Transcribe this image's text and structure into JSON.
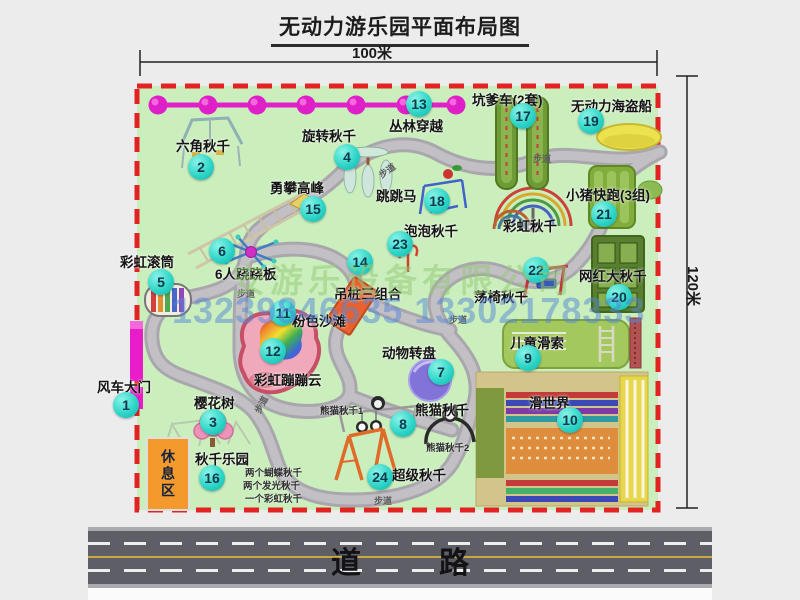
{
  "title": "无动力游乐园平面布局图",
  "dimensions": {
    "width_label": "100米",
    "height_label": "120米"
  },
  "watermark": {
    "company": "安游乐设备有限公司",
    "phone": "13239846635 13302178333"
  },
  "road": {
    "label": "道　路"
  },
  "rest_area": {
    "label": "休息区"
  },
  "rainbow_swing_label": "彩虹秋千",
  "walkways": {
    "label": "步道",
    "positions": [
      {
        "x": 378,
        "y": 164,
        "r": -35
      },
      {
        "x": 533,
        "y": 152,
        "r": 0
      },
      {
        "x": 237,
        "y": 287,
        "r": 0
      },
      {
        "x": 449,
        "y": 313,
        "r": 0
      },
      {
        "x": 252,
        "y": 398,
        "r": -62
      },
      {
        "x": 374,
        "y": 494,
        "r": 0
      }
    ]
  },
  "panda_notes": {
    "n1": "熊猫秋千1",
    "n2": "熊猫秋千2"
  },
  "swing_park": {
    "notes": [
      "两个蝴蝶秋千",
      "两个发光秋千",
      "一个彩虹秋千"
    ]
  },
  "items": [
    {
      "num": 1,
      "label": "风车大门",
      "bx": 126,
      "by": 405,
      "lx": 97,
      "ly": 376
    },
    {
      "num": 2,
      "label": "六角秋千",
      "bx": 201,
      "by": 167,
      "lx": 176,
      "ly": 135
    },
    {
      "num": 3,
      "label": "樱花树",
      "bx": 213,
      "by": 422,
      "lx": 194,
      "ly": 392
    },
    {
      "num": 4,
      "label": "旋转秋千",
      "bx": 347,
      "by": 157,
      "lx": 302,
      "ly": 125
    },
    {
      "num": 5,
      "label": "彩虹滚筒",
      "bx": 161,
      "by": 282,
      "lx": 120,
      "ly": 251
    },
    {
      "num": 6,
      "label": "6人跷跷板",
      "bx": 222,
      "by": 251,
      "lx": 215,
      "ly": 263
    },
    {
      "num": 7,
      "label": "动物转盘",
      "bx": 441,
      "by": 372,
      "lx": 382,
      "ly": 342
    },
    {
      "num": 8,
      "label": "熊猫秋千",
      "bx": 403,
      "by": 424,
      "lx": 415,
      "ly": 399
    },
    {
      "num": 9,
      "label": "儿童滑索",
      "bx": 528,
      "by": 358,
      "lx": 510,
      "ly": 332
    },
    {
      "num": 10,
      "label": "滑世界",
      "bx": 570,
      "by": 420,
      "lx": 529,
      "ly": 392
    },
    {
      "num": 11,
      "label": "粉色沙滩",
      "bx": 283,
      "by": 313,
      "lx": 292,
      "ly": 310
    },
    {
      "num": 12,
      "label": "彩虹蹦蹦云",
      "bx": 273,
      "by": 351,
      "lx": 254,
      "ly": 369
    },
    {
      "num": 13,
      "label": "丛林穿越",
      "bx": 419,
      "by": 104,
      "lx": 389,
      "ly": 115
    },
    {
      "num": 14,
      "label": "吊桩三组合",
      "bx": 360,
      "by": 262,
      "lx": 334,
      "ly": 283
    },
    {
      "num": 15,
      "label": "勇攀高峰",
      "bx": 313,
      "by": 209,
      "lx": 270,
      "ly": 177
    },
    {
      "num": 16,
      "label": "秋千乐园",
      "bx": 212,
      "by": 478,
      "lx": 195,
      "ly": 448
    },
    {
      "num": 17,
      "label": "坑爹车(2套)",
      "bx": 523,
      "by": 116,
      "lx": 472,
      "ly": 89
    },
    {
      "num": 18,
      "label": "跳跳马",
      "bx": 437,
      "by": 201,
      "lx": 376,
      "ly": 185
    },
    {
      "num": 19,
      "label": "无动力海盗船",
      "bx": 591,
      "by": 121,
      "lx": 571,
      "ly": 95
    },
    {
      "num": 20,
      "label": "网红大秋千",
      "bx": 619,
      "by": 297,
      "lx": 579,
      "ly": 265
    },
    {
      "num": 21,
      "label": "小猪快跑(3组)",
      "bx": 604,
      "by": 214,
      "lx": 566,
      "ly": 184
    },
    {
      "num": 22,
      "label": "荡椅秋千",
      "bx": 536,
      "by": 270,
      "lx": 474,
      "ly": 286
    },
    {
      "num": 23,
      "label": "泡泡秋千",
      "bx": 400,
      "by": 244,
      "lx": 404,
      "ly": 220
    },
    {
      "num": 24,
      "label": "超级秋千",
      "bx": 380,
      "by": 477,
      "lx": 392,
      "ly": 464
    }
  ]
}
